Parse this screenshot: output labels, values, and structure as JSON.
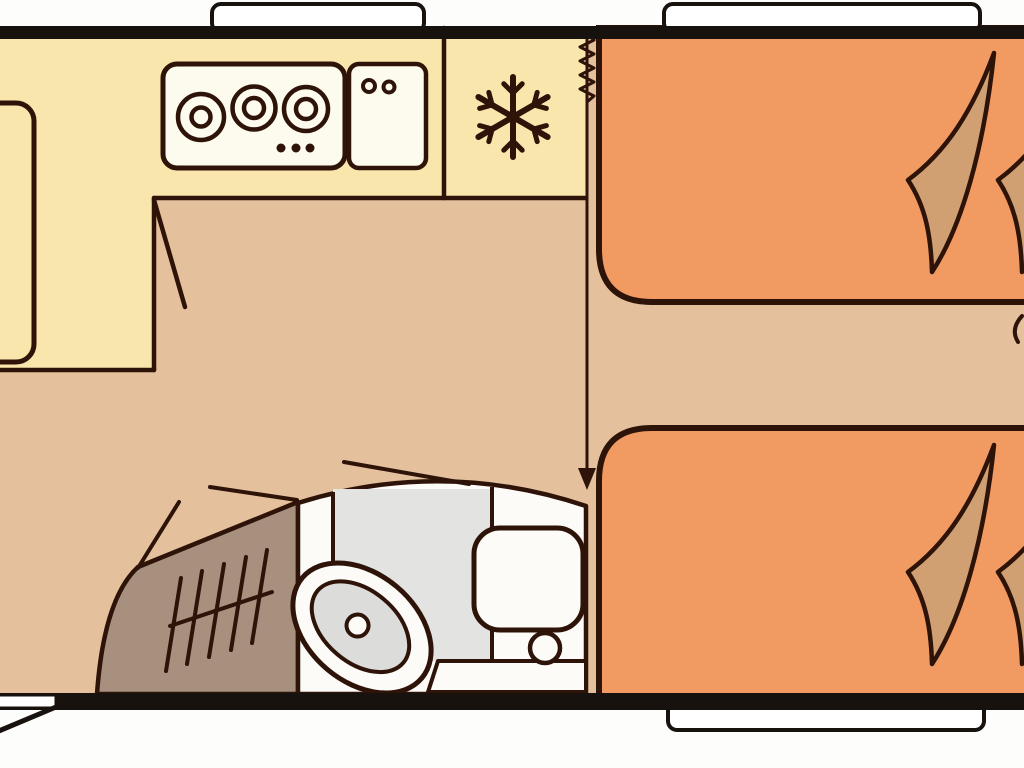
{
  "diagram": {
    "kind": "floorplan",
    "label": "Caravan / motorhome floor plan, side view layout",
    "rooms": [
      {
        "name": "kitchen",
        "features": [
          "hob",
          "sink",
          "refrigerator",
          "worktop"
        ]
      },
      {
        "name": "sleeping-area",
        "features": [
          "single-bed-top",
          "single-bed-bottom"
        ]
      },
      {
        "name": "bathroom",
        "features": [
          "shower-tray",
          "washbasin",
          "toilet"
        ]
      },
      {
        "name": "wardrobe",
        "features": [
          "clothes-rail",
          "hangers"
        ]
      }
    ]
  },
  "icons": [
    {
      "name": "snowflake-icon",
      "meaning": "refrigerator"
    },
    {
      "name": "hob-burner-icon",
      "meaning": "cooking ring"
    },
    {
      "name": "faucet-dots-icon",
      "meaning": "sink taps"
    },
    {
      "name": "hanger-rail-icon",
      "meaning": "wardrobe rail"
    },
    {
      "name": "door-swing-icon",
      "meaning": "door opening arc"
    },
    {
      "name": "arrow-down-icon",
      "meaning": "passage direction"
    },
    {
      "name": "zigzag-icon",
      "meaning": "concertina partition"
    }
  ],
  "counts": {
    "hob_burners": 3,
    "hob_control_dots": 3,
    "faucet_dots": 2,
    "beds": 2,
    "blanket_folds": 4,
    "windows_top": 2,
    "windows_bottom": 1,
    "entry_doors": 1,
    "wardrobe_hangers": 5
  },
  "colors": {
    "exterior": "#FDFDFC",
    "wall": "#17120E",
    "outline": "#2E1309",
    "kitchen_yellow": "#F9E6AC",
    "floor_tan": "#E4C09C",
    "bed_orange": "#F19B62",
    "blanket_tan": "#D0A073",
    "wardrobe_brown": "#A8907E",
    "shower_grey": "#E3E3E1",
    "basin_grey": "#DCDCDA",
    "fixture_white": "#FCFBF7",
    "counter_cream": "#FDFAEE"
  }
}
